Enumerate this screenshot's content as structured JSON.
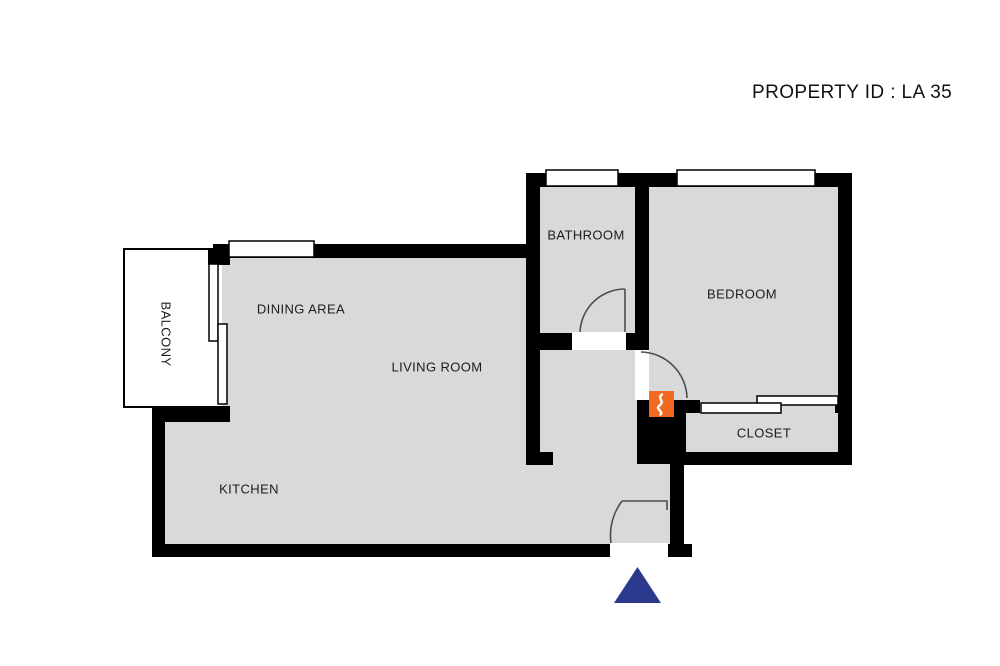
{
  "header": {
    "property_id": "PROPERTY ID : LA 35"
  },
  "rooms": {
    "balcony": {
      "label": "BALCONY"
    },
    "dining": {
      "label": "DINING AREA"
    },
    "living": {
      "label": "LIVING ROOM"
    },
    "kitchen": {
      "label": "KITCHEN"
    },
    "bathroom": {
      "label": "BATHROOM"
    },
    "bedroom": {
      "label": "BEDROOM"
    },
    "closet": {
      "label": "CLOSET"
    }
  },
  "icons": {
    "water_heater": "water-heater-icon",
    "entrance_arrow": "entrance-arrow-icon"
  },
  "colors": {
    "floor": "#d9d9d9",
    "wall": "#000000",
    "accent_orange": "#f06a21",
    "arrow_navy": "#2c3a8e",
    "arc_stroke": "#4d4d4d"
  }
}
